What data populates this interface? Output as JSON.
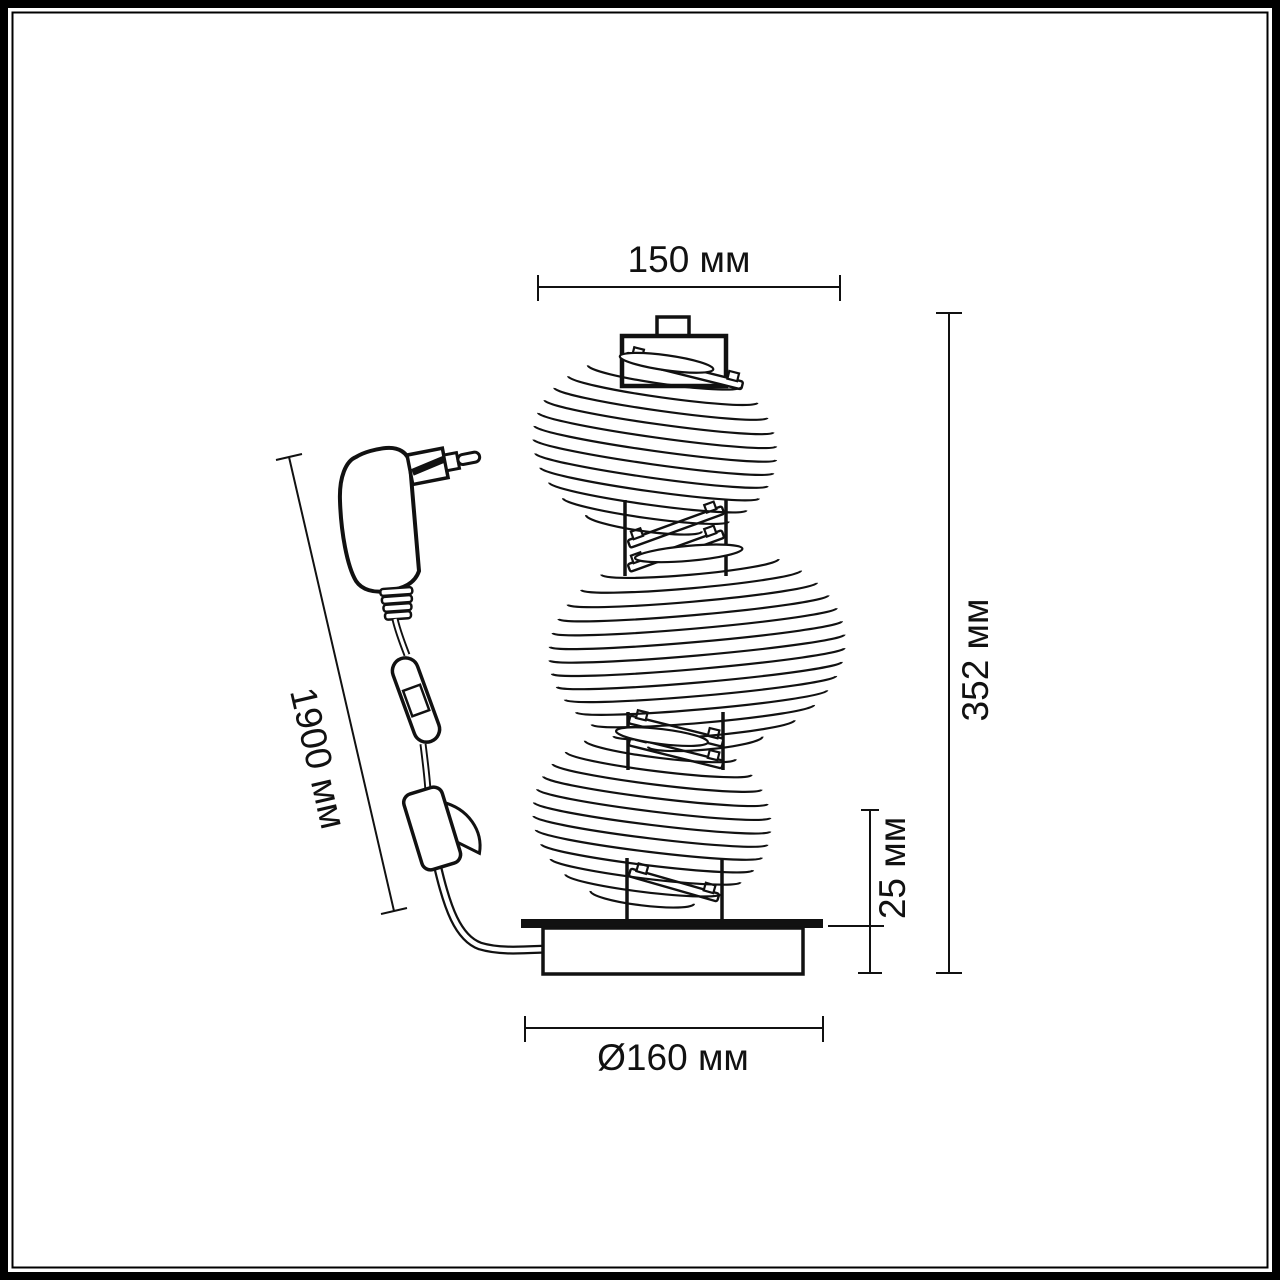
{
  "dimensions": {
    "top_width": "150 мм",
    "total_height": "352 мм",
    "base_height": "25 мм",
    "base_diameter": "Ø160 мм",
    "cord_length": "1900 мм"
  },
  "colors": {
    "line": "#111111",
    "frame": "#000000",
    "background": "#ffffff"
  }
}
